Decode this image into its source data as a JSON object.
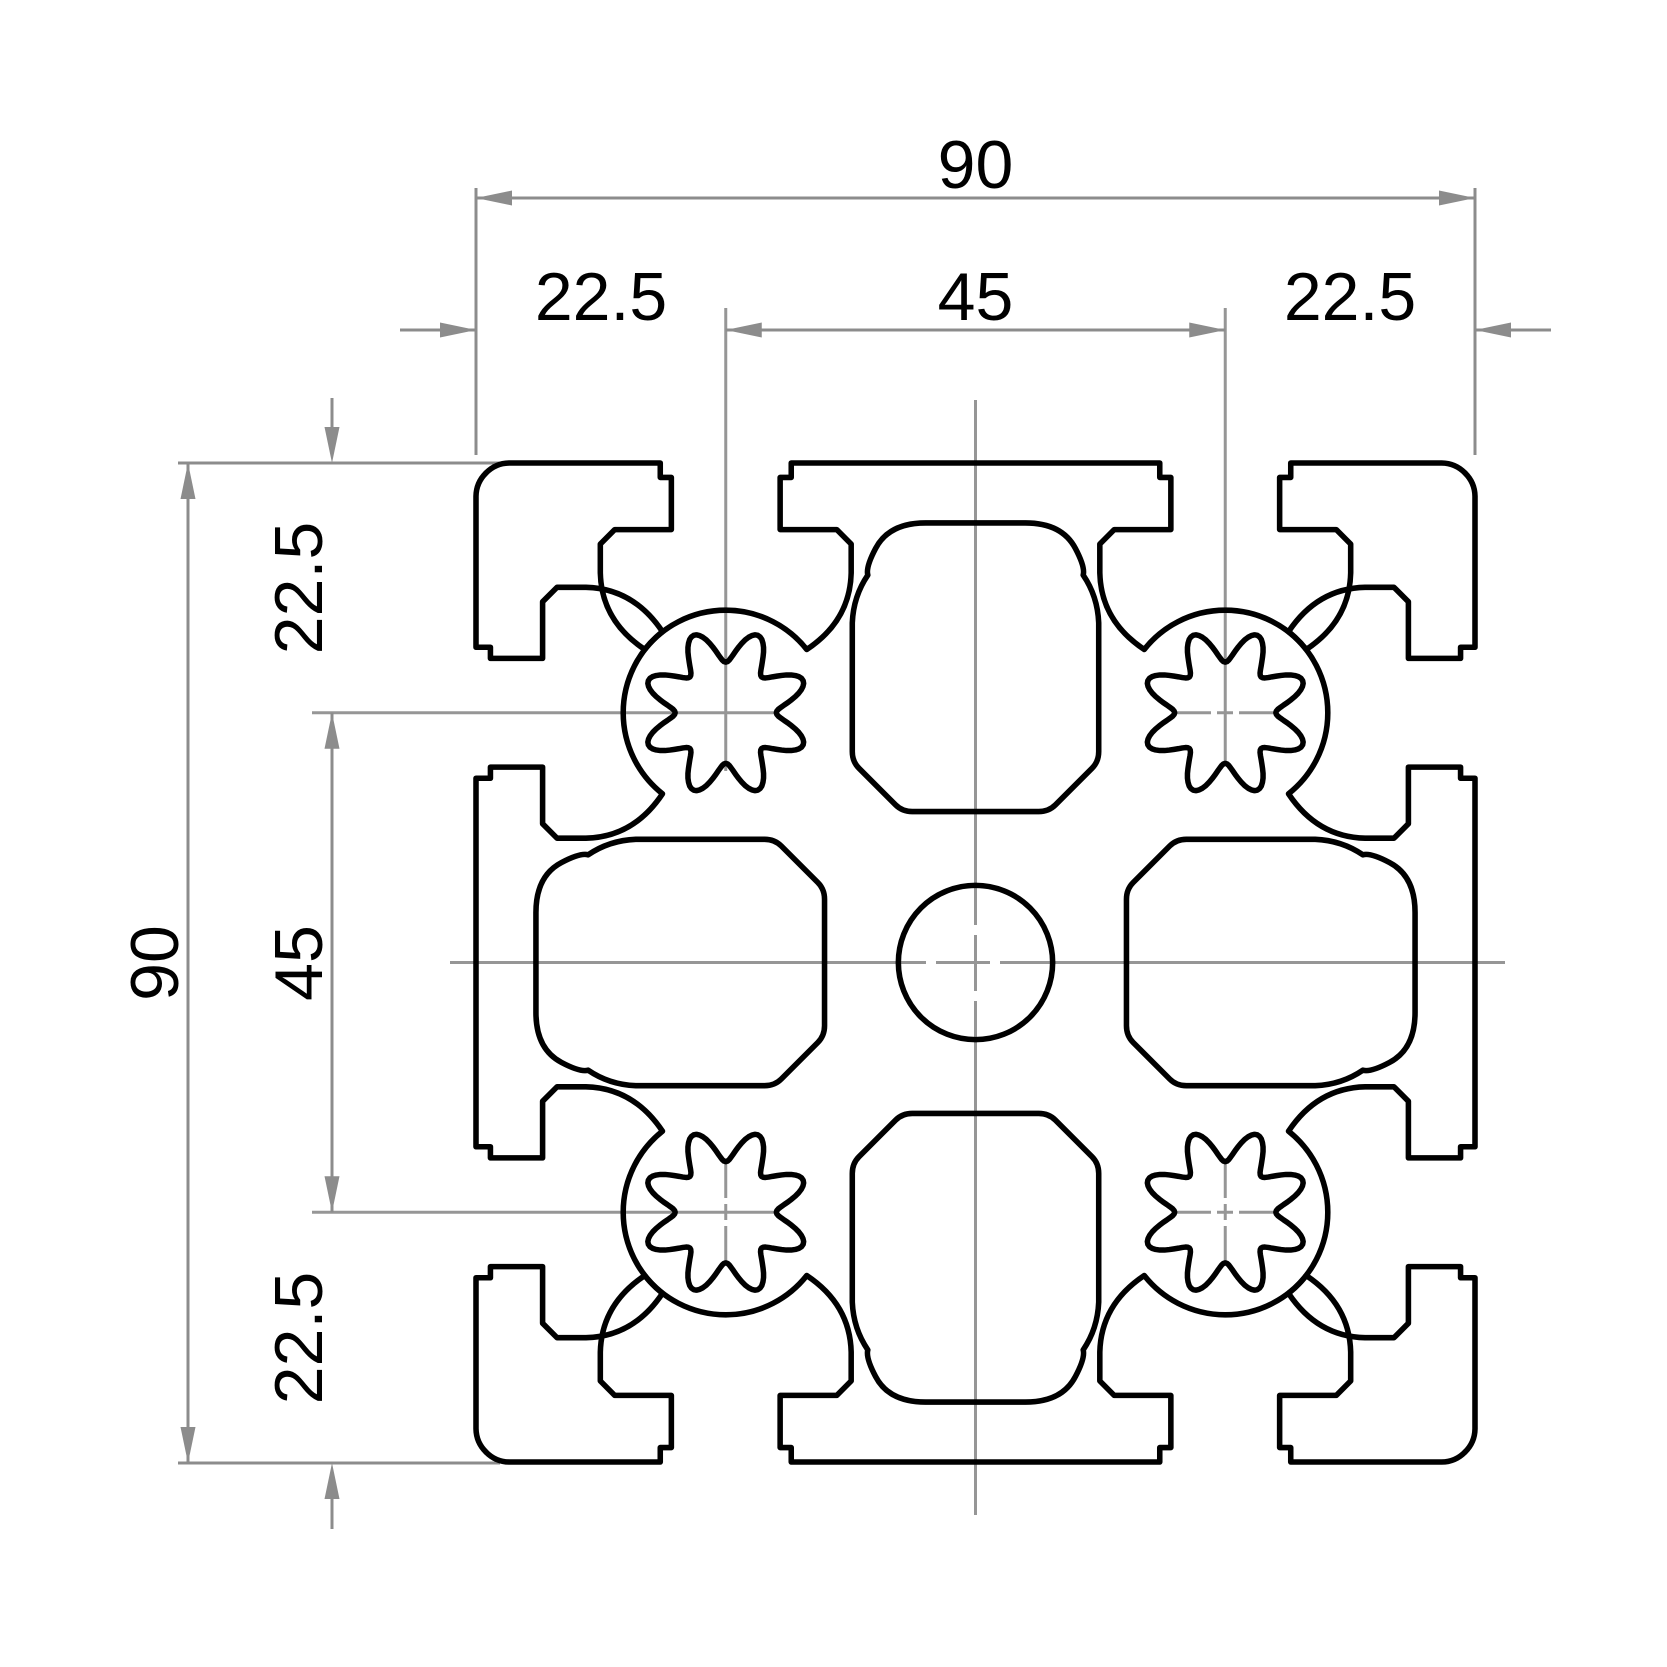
{
  "title": "90 x 90 aluminium extrusion profile cross-section drawing",
  "colors": {
    "outline": "#000000",
    "dimension": "#8c8c8c",
    "centerline": "#969696",
    "background": "#ffffff"
  },
  "dimensions": {
    "top": {
      "overall": "90",
      "segments": [
        "22.5",
        "45",
        "22.5"
      ]
    },
    "left": {
      "overall": "90",
      "segments": [
        "22.5",
        "45",
        "22.5"
      ]
    }
  },
  "profile": {
    "overall_width_mm": "90",
    "overall_height_mm": "90",
    "slot_pitch_mm": "22.5",
    "features": [
      "eight T-slots",
      "four splined screw bosses",
      "center bore",
      "four core cavities"
    ]
  }
}
